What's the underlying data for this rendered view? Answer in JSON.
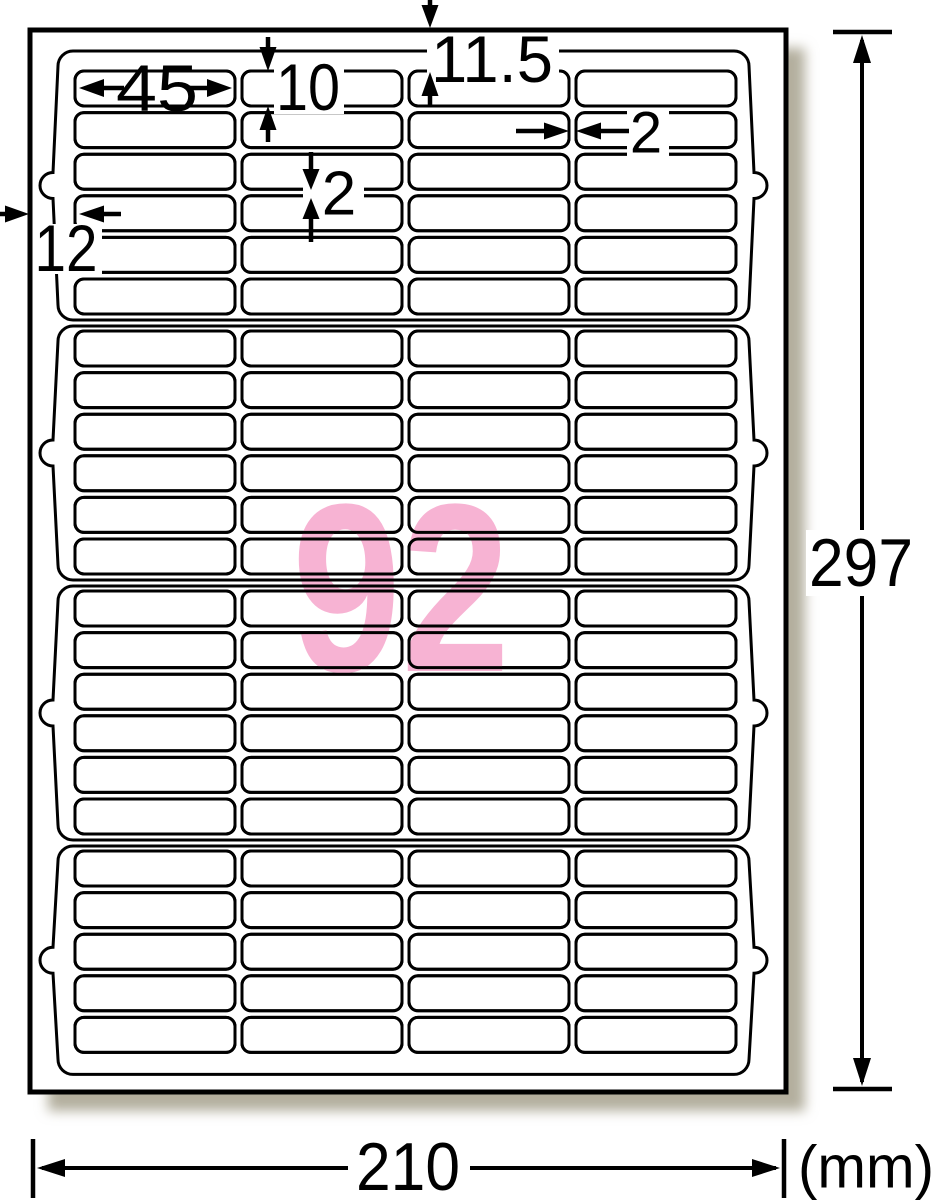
{
  "diagram": {
    "description": "label-sheet-dimension-diagram",
    "annotations": {
      "label_width": "45",
      "label_height": "10",
      "top_margin": "11.5",
      "row_gap": "2",
      "col_gap": "2",
      "side_margin": "12",
      "sheet_height": "297",
      "sheet_width": "210",
      "unit": "(mm)",
      "label_count": "92"
    },
    "layout": {
      "columns": 4,
      "rows_per_block": [
        6,
        6,
        6,
        5
      ],
      "total_labels": 92,
      "blocks": 4
    },
    "colors": {
      "ink": "#000000",
      "paper": "#ffffff",
      "count_pink": "#f7b3d3",
      "shadow": "#b3af9e"
    }
  }
}
